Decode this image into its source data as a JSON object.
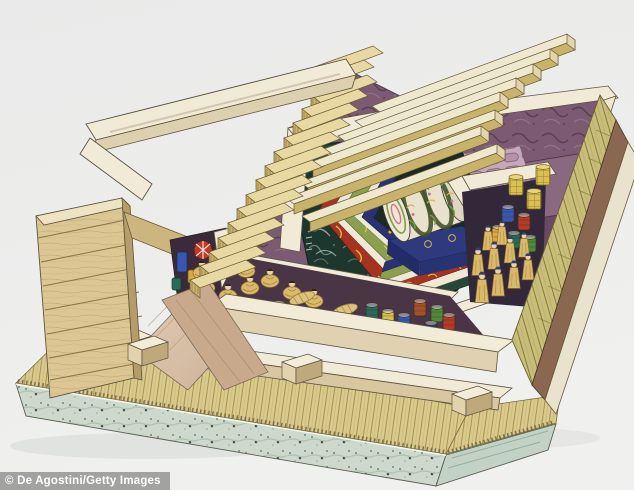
{
  "image": {
    "alt": "Cutaway watercolor illustration of an ancient Chinese timber-chambered tomb with nested lacquered coffins, attendant figures and burial goods",
    "credit": "© De Agostini/Getty Images"
  },
  "scene": {
    "structure": [
      "stepped timber entrance staircase descending into the pit",
      "parallel timber ceiling beams partly covering the chamber",
      "white plastered rims on top of the chamber walls",
      "purple textured earthen pit walls",
      "sloped access ramp crossing the front wall",
      "stacked-timber corner wall",
      "bamboo plank floor",
      "mottled stone foundation slab"
    ],
    "center": [
      "dark green lacquered outer coffin with pale swirl motifs",
      "nested red-gold, green and blue ornamented coffin shells",
      "cylindrical inner coffin with floral scroll decoration on a blue platform",
      "stepped painted dais bands"
    ],
    "chambers": [
      "front chamber with seated mourners and wrapped bundles",
      "side niche with drum and bronze vessels at the stair foot",
      "right chamber with standing attendants, glazed jars and woven baskets"
    ]
  },
  "palette": {
    "background": "#ecedec",
    "cream_rim": "#f1ead6",
    "tan_wood": "#cdb873",
    "bamboo_floor": "#d9ca8e",
    "foundation": "#cdd9cd",
    "purple_wall": "#7c5a74",
    "mauve_light": "#c4a8bc",
    "coffin_teal": "#1d372f",
    "band_red": "#a63222",
    "band_green": "#8ba04e",
    "band_blue": "#2b3272",
    "gold": "#e3b93e",
    "robe_tan": "#d9b96a",
    "jar_blue": "#3a57b0",
    "jar_red": "#b53a28",
    "jar_green": "#4e8a3c",
    "basket_yellow": "#d9c050",
    "watermark_gray": "#969696"
  }
}
